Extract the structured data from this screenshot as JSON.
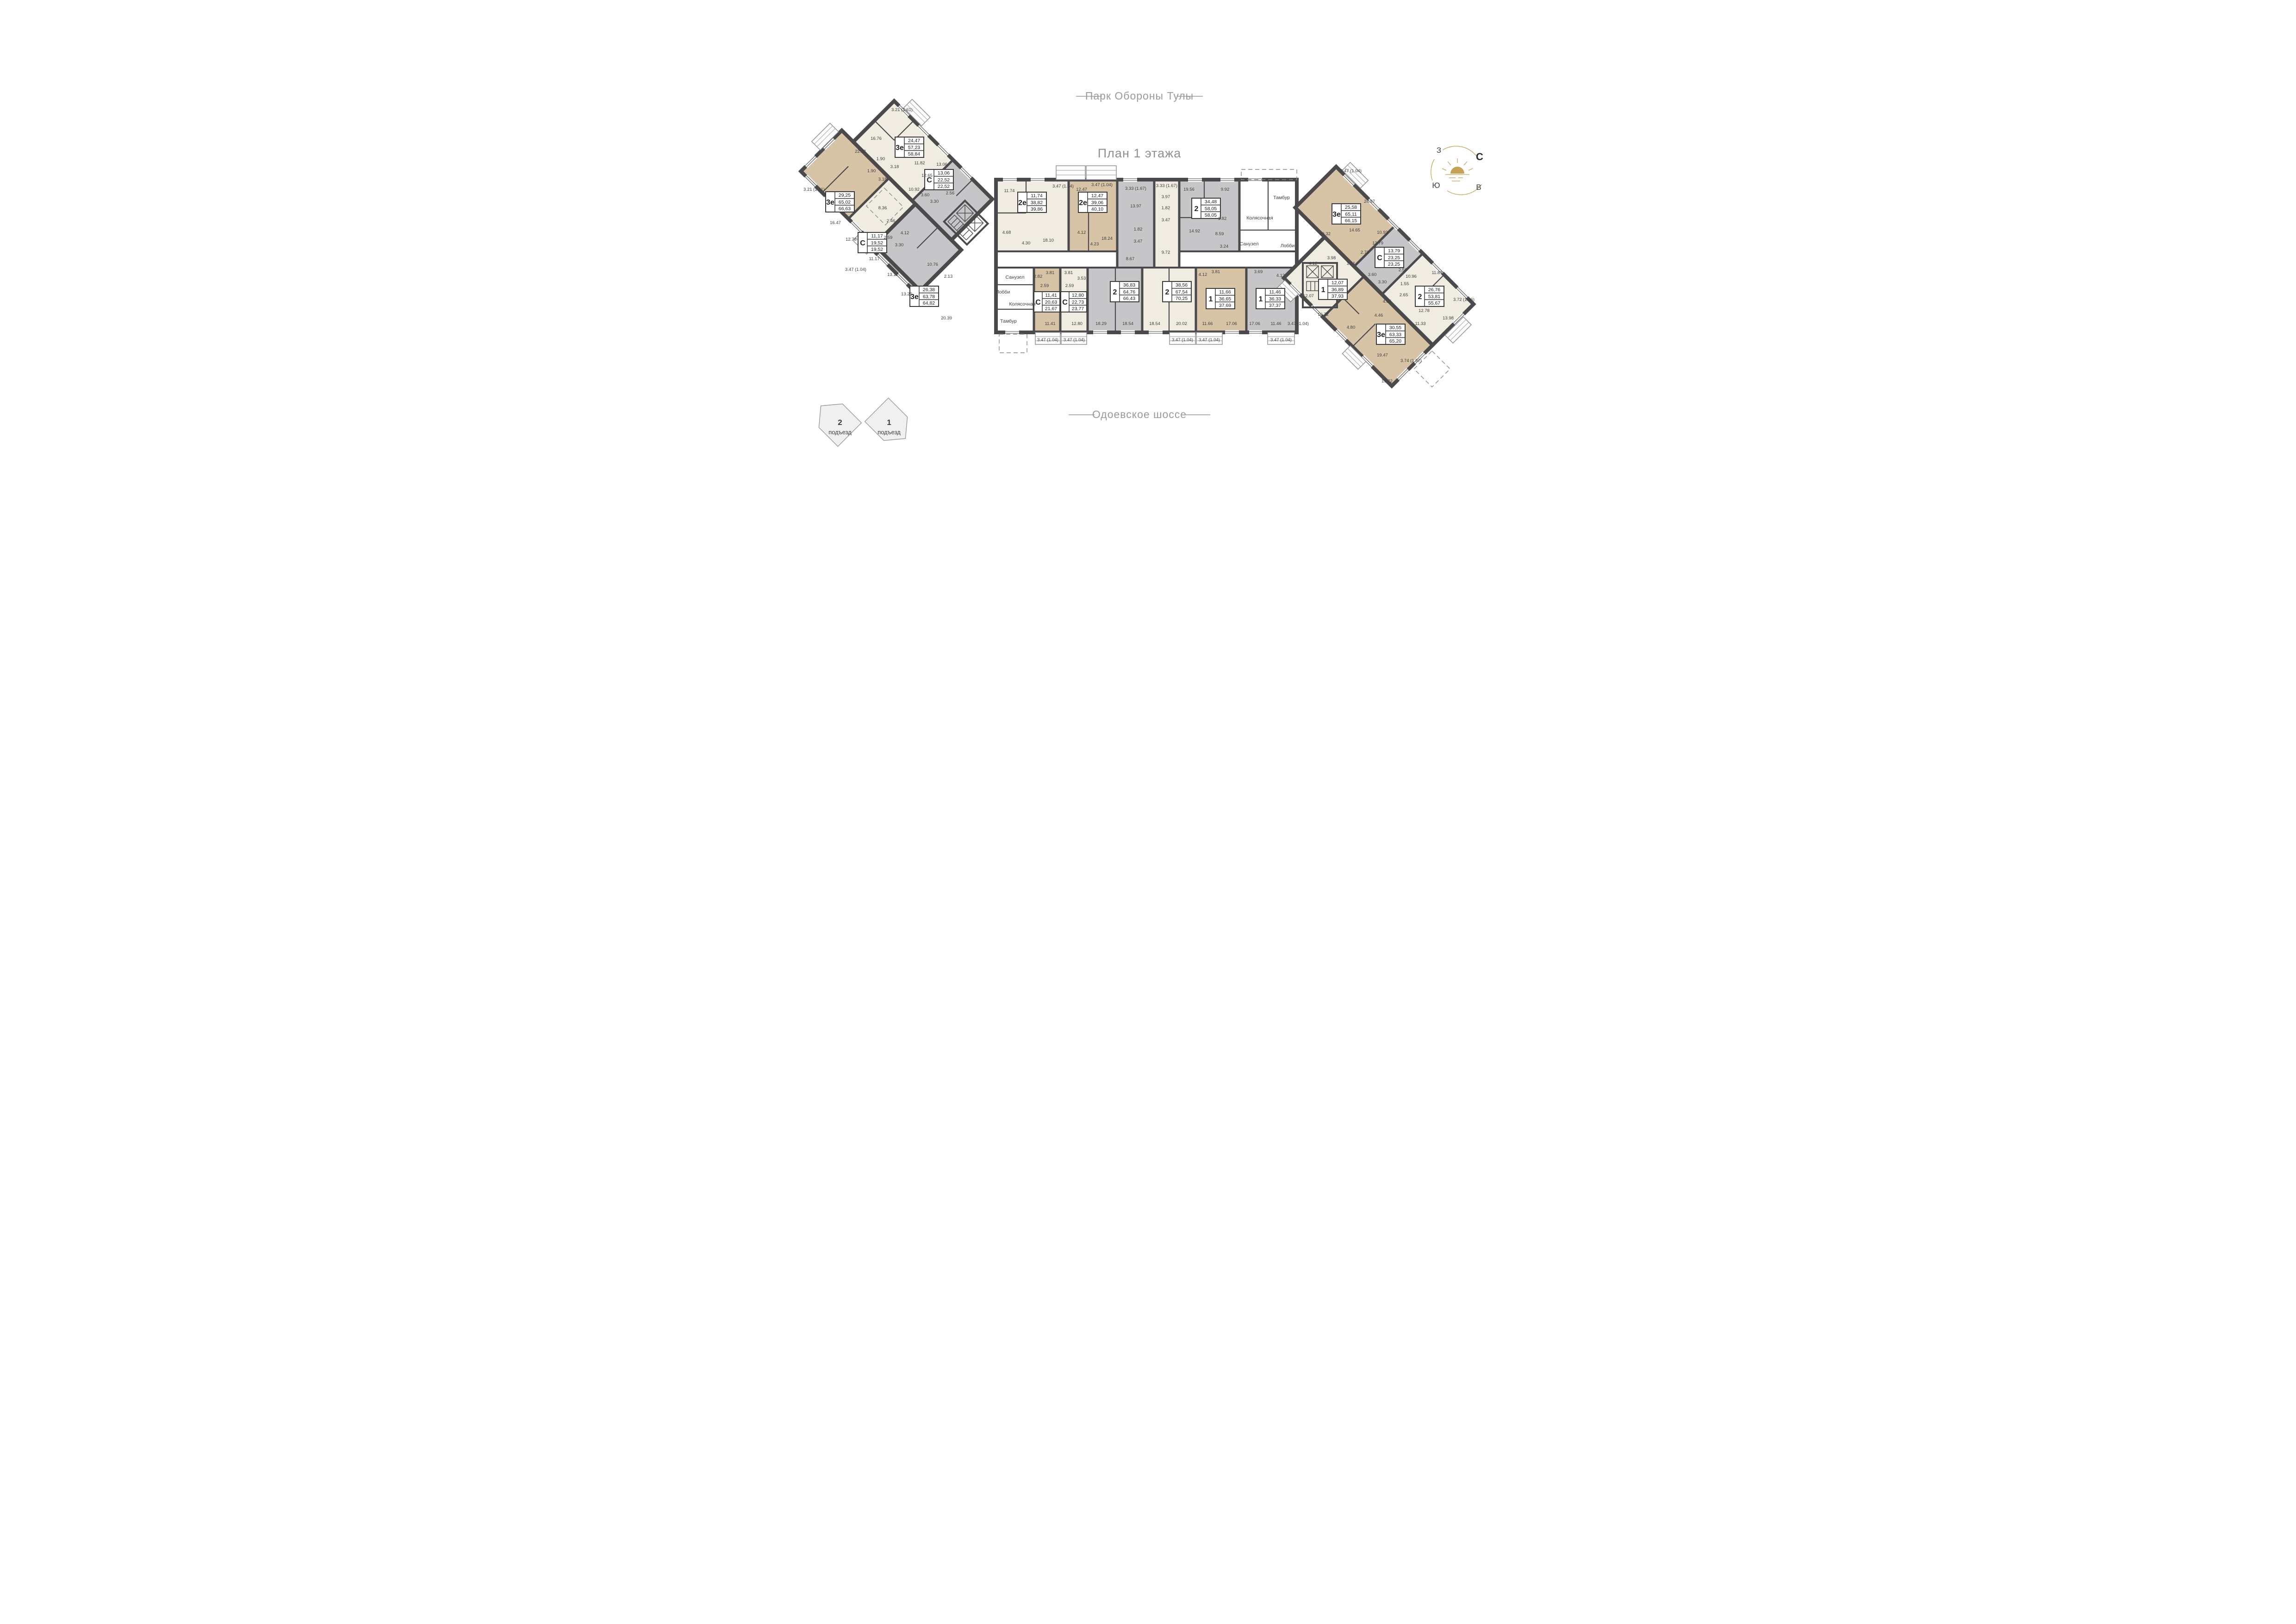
{
  "titles": {
    "plan": "План 1 этажа",
    "park": "Парк Обороны Тулы",
    "road": "Одоевское шоссе"
  },
  "compass": {
    "west": "З",
    "north": "С",
    "south": "Ю",
    "east": "В"
  },
  "entrances": [
    {
      "number": "2",
      "label": "подъезд"
    },
    {
      "number": "1",
      "label": "подъезд"
    }
  ],
  "commons_left": {
    "bath": "Санузел",
    "lobby": "Лобби",
    "stroller": "Колясочная",
    "tambour": "Тамбур"
  },
  "commons_right": {
    "tambour": "Тамбур",
    "stroller": "Колясочная",
    "bath": "Санузел",
    "lobby": "Лобби"
  },
  "apartments": {
    "l3a": {
      "type": "3е",
      "areas": [
        "24,47",
        "57,23",
        "58,84"
      ],
      "rooms": [
        "16.76",
        "22.33",
        "1.90",
        "1.90",
        "3.18",
        "3.18",
        "11.82",
        "12.65",
        "10.92"
      ],
      "balcony": "3.21 (1.61)"
    },
    "l3c": {
      "type": "С",
      "areas": [
        "13,06",
        "22,52",
        "22,52"
      ],
      "rooms": [
        "13.06",
        "2.56",
        "3.60",
        "3.30"
      ]
    },
    "l3b": {
      "type": "3е",
      "areas": [
        "29,25",
        "65,02",
        "66,63"
      ],
      "rooms": [
        "16.47",
        "12.78",
        "8.36",
        "2.46",
        "4.12"
      ],
      "balcony": "3.21 (1.61)"
    },
    "lcc": {
      "type": "С",
      "areas": [
        "11,17",
        "19,52",
        "19,52"
      ],
      "rooms": [
        "11.17",
        "2.59",
        "3.30"
      ],
      "balcony": "3.47 (1.04)"
    },
    "l3g": {
      "type": "3е",
      "areas": [
        "26,38",
        "63,78",
        "64,82"
      ],
      "rooms": [
        "13.12",
        "13.26",
        "10.76",
        "2.13",
        "20.39"
      ]
    },
    "c2e1": {
      "type": "2е",
      "areas": [
        "11,74",
        "38,82",
        "39,86"
      ],
      "rooms": [
        "11.74",
        "4.68",
        "4.30",
        "18.10"
      ],
      "balcony": "3.47 (1.04)"
    },
    "c2e2": {
      "type": "2е",
      "areas": [
        "12,47",
        "39,06",
        "40,10"
      ],
      "rooms": [
        "12.47",
        "4.12",
        "4.23",
        "18.24"
      ],
      "balcony": "3.47 (1.04)"
    },
    "c2g": {
      "type": "2",
      "areas": [
        "36,83",
        "64,76",
        "66,43"
      ],
      "rooms": [
        "13.97",
        "1.82",
        "3.47",
        "8.67",
        "18.29",
        "18.54"
      ],
      "balcony": "3.33 (1.67)"
    },
    "c2c": {
      "type": "2",
      "areas": [
        "38,56",
        "67,54",
        "70,25"
      ],
      "rooms": [
        "3.97",
        "1.82",
        "3.47",
        "9.72",
        "18.54",
        "20.02"
      ],
      "balcony": "3.33 (1.67)",
      "balcony2": "3.47 (1.04)"
    },
    "c234": {
      "type": "2",
      "areas": [
        "34,48",
        "58,05",
        "58,05"
      ],
      "rooms": [
        "19.56",
        "14.92",
        "9.92",
        "8.59",
        "1.82",
        "3.24"
      ]
    },
    "ccb": {
      "type": "С",
      "areas": [
        "11,41",
        "20,63",
        "21,67"
      ],
      "rooms": [
        "2.82",
        "3.81",
        "2.59",
        "11.41"
      ],
      "balcony": "3.47 (1.04)"
    },
    "ccc": {
      "type": "С",
      "areas": [
        "12,80",
        "22,73",
        "23,77"
      ],
      "rooms": [
        "3.81",
        "3.53",
        "2.59",
        "12.80"
      ],
      "balcony": "3.47 (1.04)"
    },
    "c1b": {
      "type": "1",
      "areas": [
        "11,66",
        "36,65",
        "37,69"
      ],
      "rooms": [
        "4.12",
        "3.81",
        "11.66",
        "17.06"
      ],
      "balcony": "3.47 (1.04)"
    },
    "c1g": {
      "type": "1",
      "areas": [
        "11,46",
        "36,33",
        "37,37"
      ],
      "rooms": [
        "3.69",
        "4.12",
        "17.06",
        "11.46"
      ],
      "balcony": "3.47 (1.04)"
    },
    "r3a": {
      "type": "3е",
      "areas": [
        "25,58",
        "65,11",
        "66,15"
      ],
      "rooms": [
        "24.97",
        "14.65",
        "10.93",
        "10.32",
        "2.73",
        "1.51"
      ],
      "balcony": "3.47 (1.04)"
    },
    "rc": {
      "type": "С",
      "areas": [
        "13,79",
        "23,25",
        "23,25"
      ],
      "rooms": [
        "13.79",
        "2.56",
        "3.60",
        "3.30"
      ]
    },
    "r2": {
      "type": "2",
      "areas": [
        "26,76",
        "53,81",
        "55,67"
      ],
      "rooms": [
        "11.89",
        "10.96",
        "12.78",
        "2.65",
        "1.55",
        "13.98"
      ],
      "balcony": "3.72 (1.86)"
    },
    "r1": {
      "type": "1",
      "areas": [
        "12,07",
        "36,89",
        "37,93"
      ],
      "rooms": [
        "12.07",
        "16.72",
        "4.12",
        "3.98"
      ],
      "balcony": "3.47 (1.04)"
    },
    "r3b": {
      "type": "3е",
      "areas": [
        "30,55",
        "63,33",
        "65,20"
      ],
      "rooms": [
        "4.05",
        "4.46",
        "4.80",
        "19.47",
        "11.33",
        "19.22"
      ],
      "balcony": "3.74 (1.87)"
    }
  },
  "colors": {
    "beige": "#d7c3a6",
    "cream": "#f1ece2",
    "gray": "#c6c6c8",
    "wall": "#4a4a4c",
    "gold": "#c6a254",
    "text": "#3d3d3d",
    "muted": "#9a9a9a"
  }
}
